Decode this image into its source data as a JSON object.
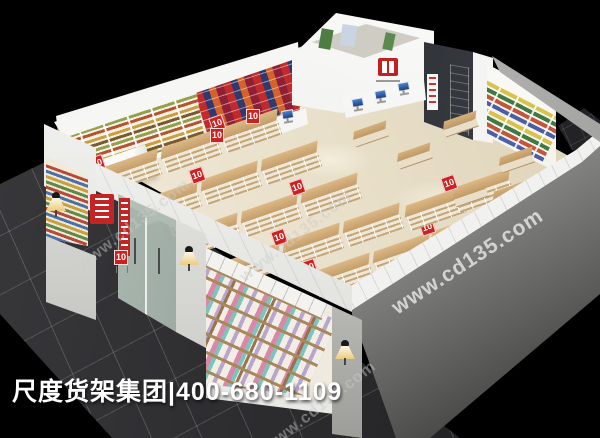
{
  "scene": {
    "background": "#000000",
    "branding_text": "尺度货架集团|400-680-1109",
    "watermark_text": "www.cd135.com",
    "price_sign_label": "10",
    "palette": {
      "walkway_tile": "#2e2e31",
      "store_floor": "#ebe3d2",
      "wall_white": "#f2f2f0",
      "exterior_wall_dark": "#4a4a4a",
      "wood_shelf": "#c9a36b",
      "sign_red": "#cc1f1f",
      "pos_monitor_blue": "#2f66b0",
      "lamp_glow": "#f3e3b8"
    }
  }
}
